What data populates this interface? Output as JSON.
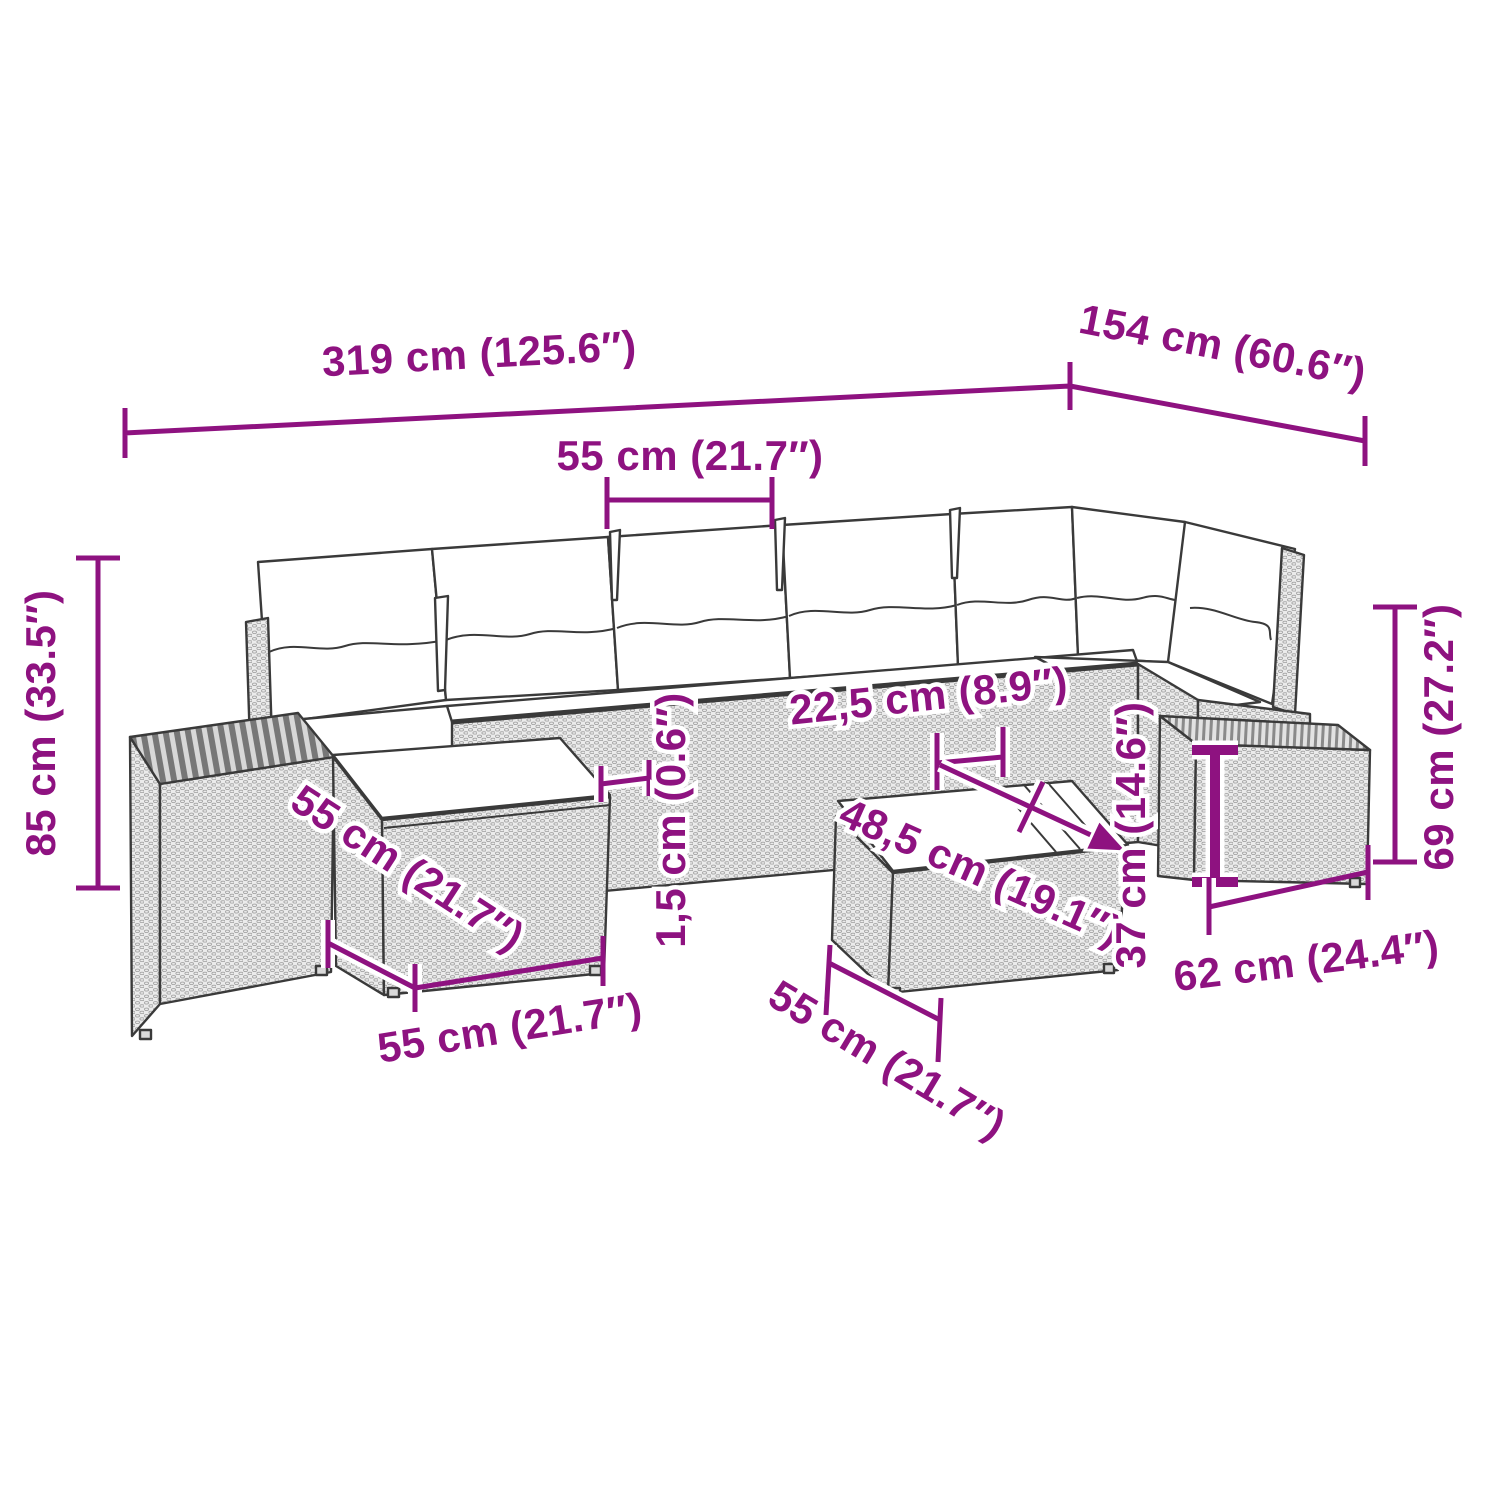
{
  "diagram": {
    "kind": "furniture-dimension-line-drawing",
    "subject": "rattan garden lounge set with cushions, ottomans, side tables and coffee table",
    "background_color": "#FFFFFF",
    "outline_color": "#3A3A3A",
    "accent_color": "#8E1280",
    "rattan_fill": "#EBEBEB",
    "wood_fill": "#777777",
    "cushion_fill": "#FFFFFF"
  },
  "dimensions": {
    "total_length": "319 cm (125.6″)",
    "total_depth": "154 cm (60.6″)",
    "seat_width": "55 cm (21.7″)",
    "total_height": "85 cm (33.5″)",
    "side_height": "69 cm (27.2″)",
    "armrest_width": "22,5 cm (8.9″)",
    "table_length": "48,5 cm (19.1″)",
    "seat_edge_thickness": "1,5 cm (0.6″)",
    "table_height": "37 cm (14.6″)",
    "side_table_width": "62 cm (24.4″)",
    "ottoman_depth": "55 cm (21.7″)",
    "ottoman_width": "55 cm (21.7″)",
    "stool_depth": "55 cm (21.7″)"
  }
}
